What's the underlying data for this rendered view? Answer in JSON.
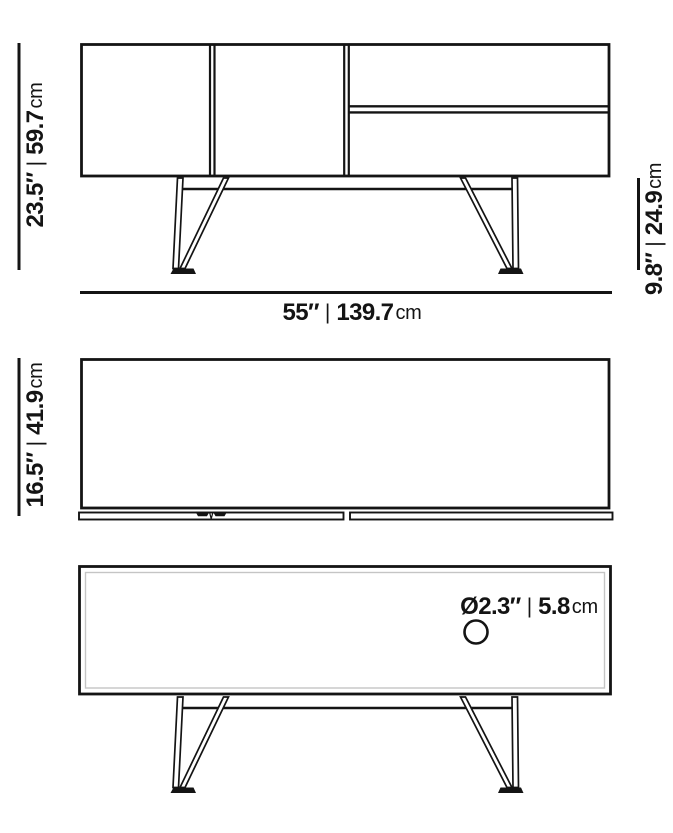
{
  "colors": {
    "line": "#141414",
    "inner_edge": "#c5c5c5",
    "background": "#ffffff"
  },
  "labels": {
    "front_height": {
      "imperial": "23.5″",
      "separator": "|",
      "metric": "59.7",
      "unit": "cm"
    },
    "leg_height": {
      "imperial": "9.8″",
      "separator": "|",
      "metric": "24.9",
      "unit": "cm"
    },
    "front_width": {
      "imperial": "55″",
      "separator": "|",
      "metric": "139.7",
      "unit": "cm"
    },
    "top_depth": {
      "imperial": "16.5″",
      "separator": "|",
      "metric": "41.9",
      "unit": "cm"
    },
    "cable_hole": {
      "imperial": "Ø2.3″",
      "separator": "|",
      "metric": "5.8",
      "unit": "cm"
    }
  }
}
